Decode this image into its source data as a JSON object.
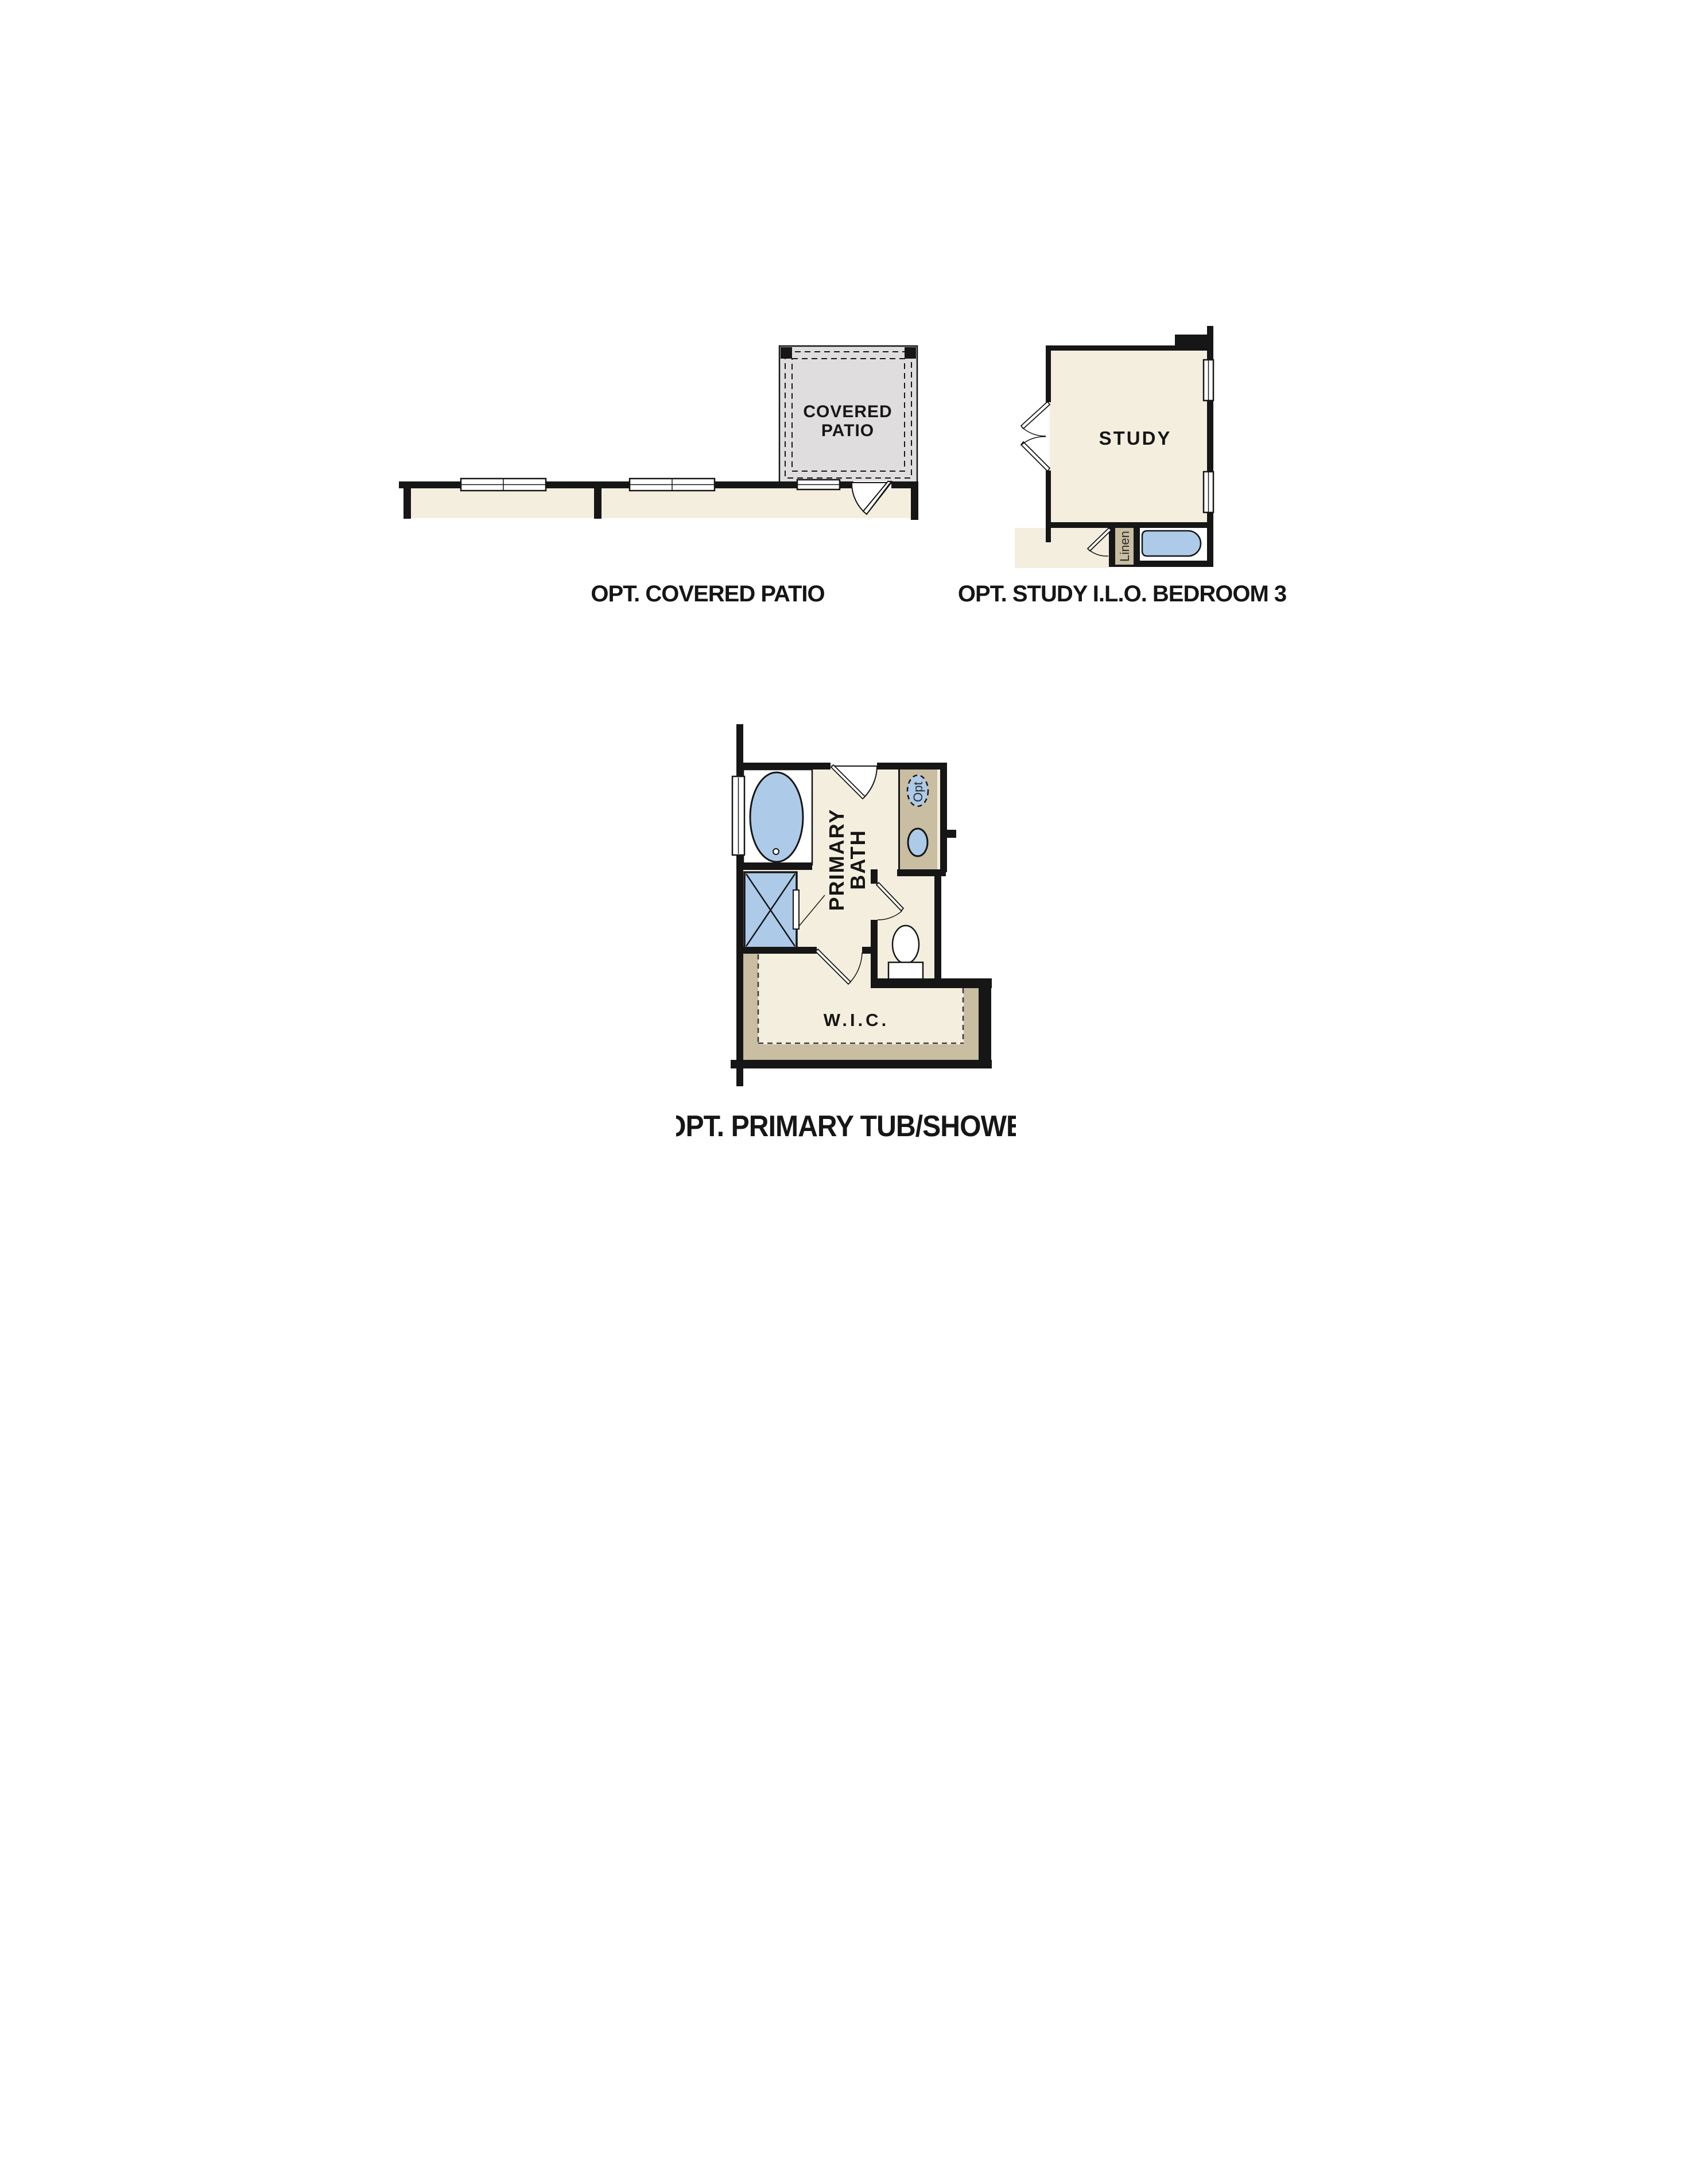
{
  "colors": {
    "wall": "#161616",
    "interior_cream": "#f4eede",
    "patio_gray": "#dfdddd",
    "tan": "#c9bda2",
    "fixture_blue": "#adcbe9",
    "white": "#ffffff"
  },
  "plans": {
    "covered_patio": {
      "room_label_lines": [
        "COVERED",
        "PATIO"
      ],
      "caption": "OPT. COVERED PATIO"
    },
    "study": {
      "room_label": "STUDY",
      "linen_label": "Linen",
      "caption": "OPT. STUDY I.L.O. BEDROOM 3"
    },
    "primary_bath": {
      "room_label_lines": [
        "PRIMARY",
        "BATH"
      ],
      "wic_label": "W.I.C.",
      "opt_fixture_label": "Opt",
      "caption": "OPT. PRIMARY TUB/SHOWER"
    }
  }
}
